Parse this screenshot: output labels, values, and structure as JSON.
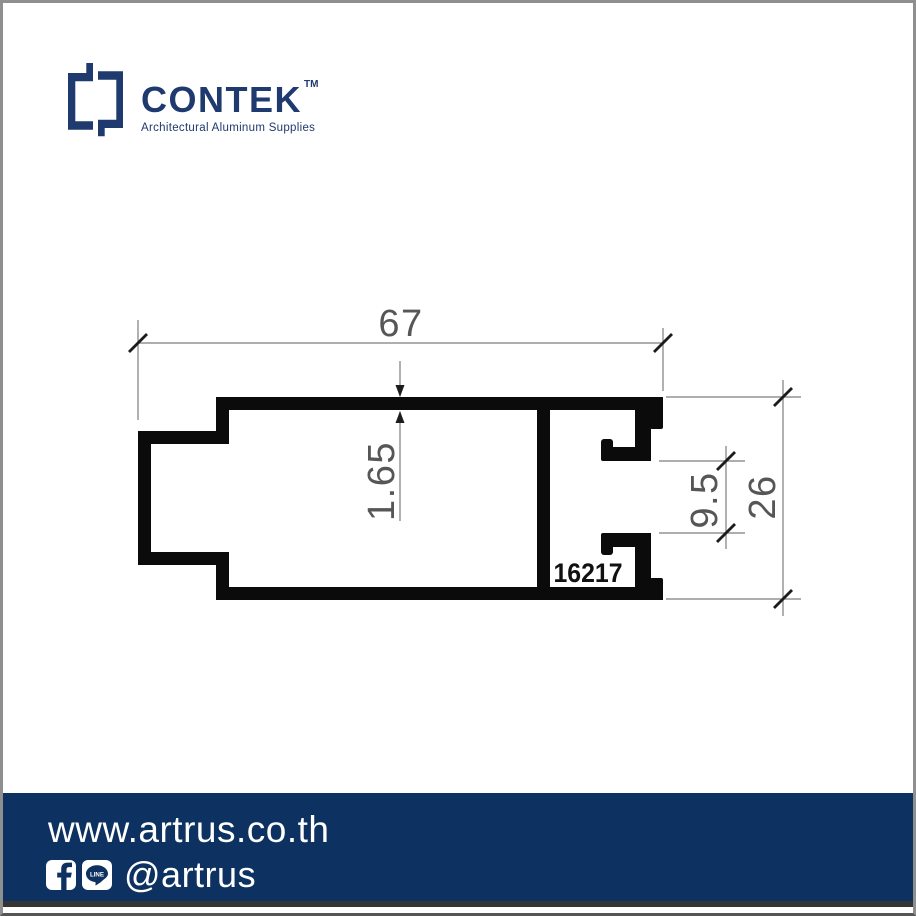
{
  "brand": {
    "name": "CONTEK",
    "trademark": "TM",
    "tagline": "Architectural Aluminum Supplies"
  },
  "drawing": {
    "part_number": "16217",
    "dimensions": {
      "overall_width": "67",
      "wall_thickness": "1.65",
      "channel_opening": "9.5",
      "overall_height": "26"
    }
  },
  "footer": {
    "website": "www.artrus.co.th",
    "social_handle": "@artrus",
    "line_label": "LINE"
  },
  "colors": {
    "brand_navy": "#1e3a6e",
    "footer_navy": "#0d3160",
    "drawing_black": "#0b0b0b",
    "dimension_gray": "#565656"
  }
}
